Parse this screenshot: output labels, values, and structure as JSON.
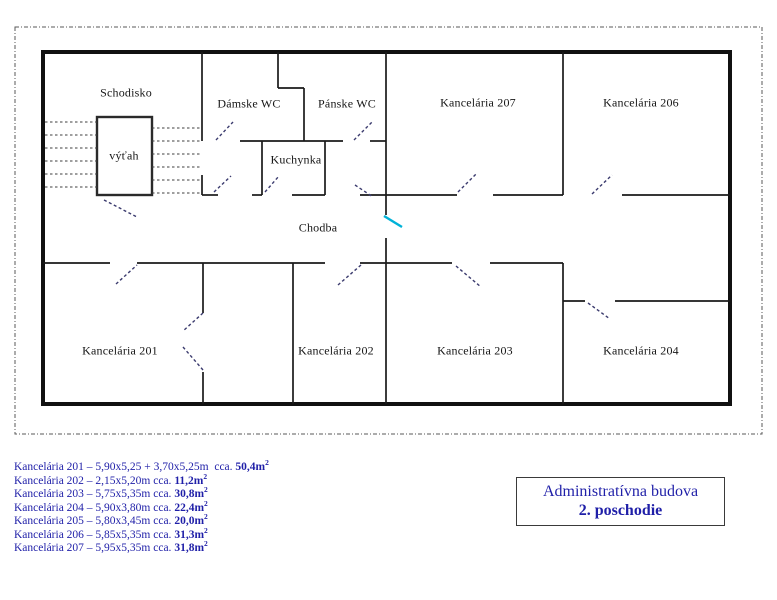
{
  "plan": {
    "rooms": {
      "schodisko": "Schodisko",
      "vytah": "výťah",
      "damske_wc": "Dámske WC",
      "panske_wc": "Pánske WC",
      "kuchynka": "Kuchynka",
      "chodba": "Chodba",
      "k201": "Kancelária 201",
      "k202": "Kancelária 202",
      "k203": "Kancelária 203",
      "k204": "Kancelária 204",
      "k206": "Kancelária 206",
      "k207": "Kancelária 207"
    }
  },
  "legend": {
    "items": [
      {
        "text": "Kancelária 201 – 5,90x5,25 + 3,70x5,25m  cca. ",
        "area": "50,4m",
        "sup": "2"
      },
      {
        "text": "Kancelária 202 – 2,15x5,20m cca. ",
        "area": "11,2m",
        "sup": "2"
      },
      {
        "text": "Kancelária 203 – 5,75x5,35m cca. ",
        "area": "30,8m",
        "sup": "2"
      },
      {
        "text": "Kancelária 204 – 5,90x3,80m cca. ",
        "area": "22,4m",
        "sup": "2"
      },
      {
        "text": "Kancelária 205 – 5,80x3,45m cca. ",
        "area": "20,0m",
        "sup": "2"
      },
      {
        "text": "Kancelária 206 – 5,85x5,35m cca. ",
        "area": "31,3m",
        "sup": "2"
      },
      {
        "text": "Kancelária 207 – 5,95x5,35m cca. ",
        "area": "31,8m",
        "sup": "2"
      }
    ]
  },
  "title_box": {
    "line1": "Administratívna budova",
    "line2": "2. poschodie"
  },
  "colors": {
    "wall": "#1a1a1a",
    "door_swing_dash": "#3b3b6e",
    "corridor_door_cyan": "#00b2d8",
    "text_blue": "#1f1fa8"
  }
}
